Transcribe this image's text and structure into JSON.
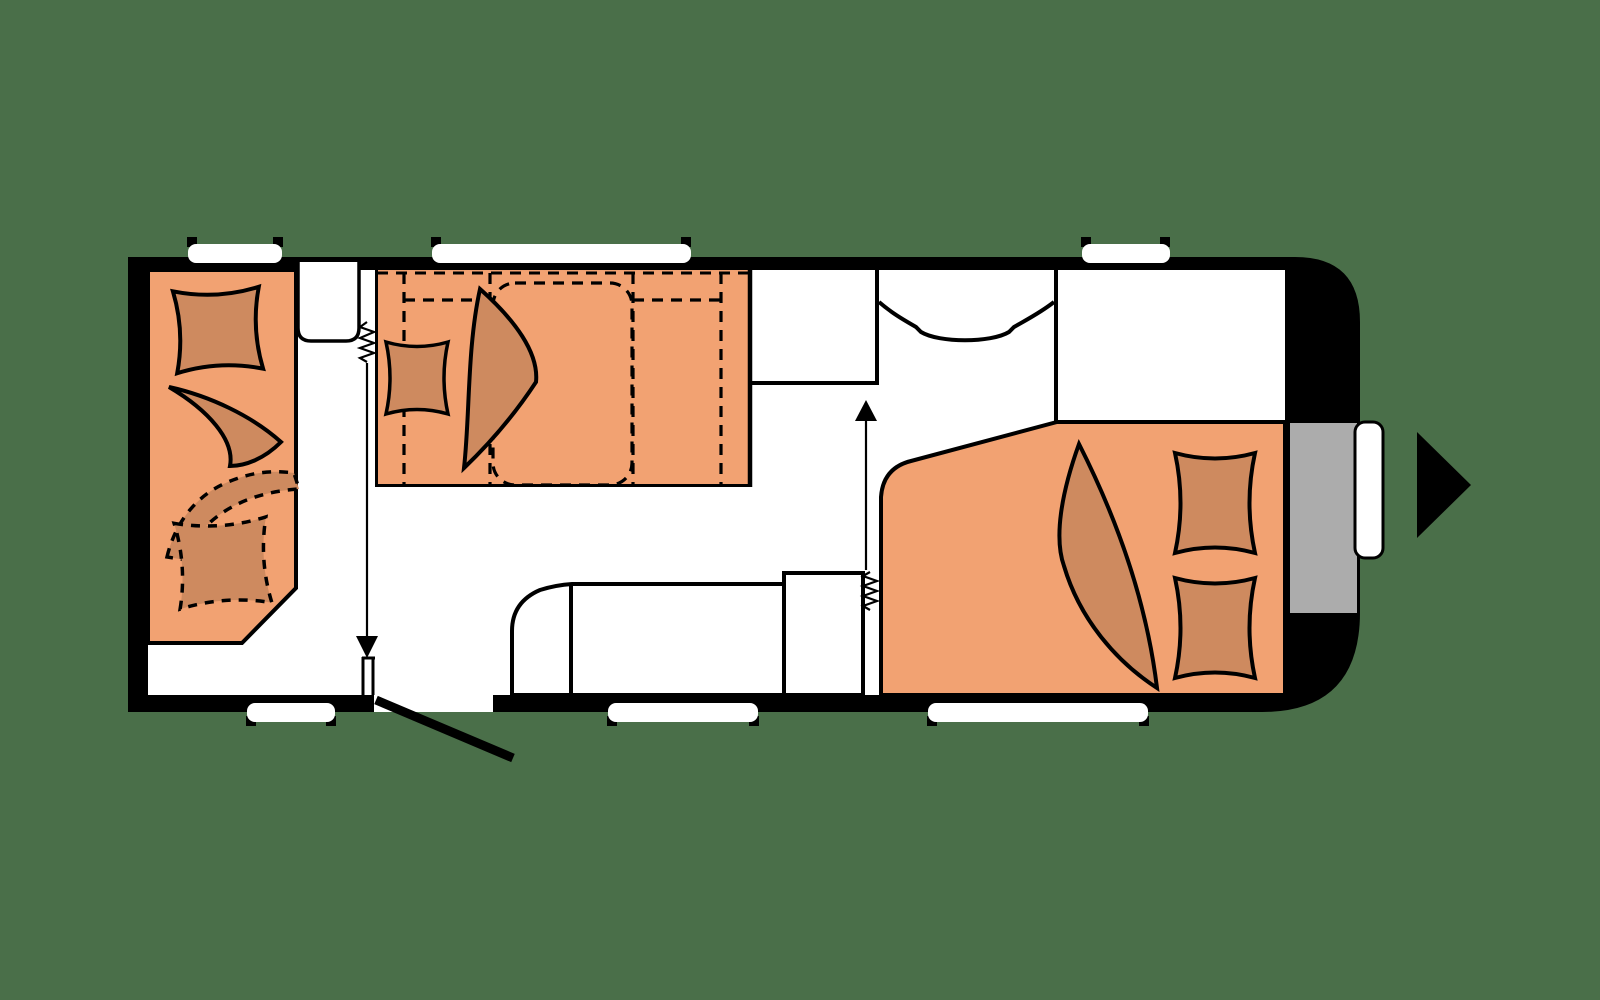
{
  "title": "Caravan floor plan",
  "colors": {
    "background": "#4A6F49",
    "outline": "#000000",
    "floor": "#FFFFFF",
    "upholstery": "#F2A272",
    "cushion": "#CE8A5F",
    "door": "#ACACAC",
    "window": "#FFFFFF"
  },
  "icons": {
    "travel_direction": "right-arrow-triangle",
    "sliding_door_front": "down-arrow-with-spring",
    "sliding_door_rear": "up-arrow-with-spring",
    "entry_door": "diagonal-door-leaf",
    "wardrobe": "hanging-rail-curve"
  },
  "regions": {
    "front_lounge": "dinette with cushions (2 solid, 2 dashed)",
    "center_bunks": "bunk bed with mattress, pillow and blanket",
    "kitchen": "kitchen counter with rounded end and tall cabinet",
    "washroom": "washroom with sliding door",
    "wardrobe": "wardrobe with curved rail",
    "rear_bed": "double bed with two pillows and blanket",
    "entry": "entry door (gray) with outside handle"
  },
  "counts": {
    "windows_top": 3,
    "windows_bottom": 3,
    "doors": 3
  }
}
